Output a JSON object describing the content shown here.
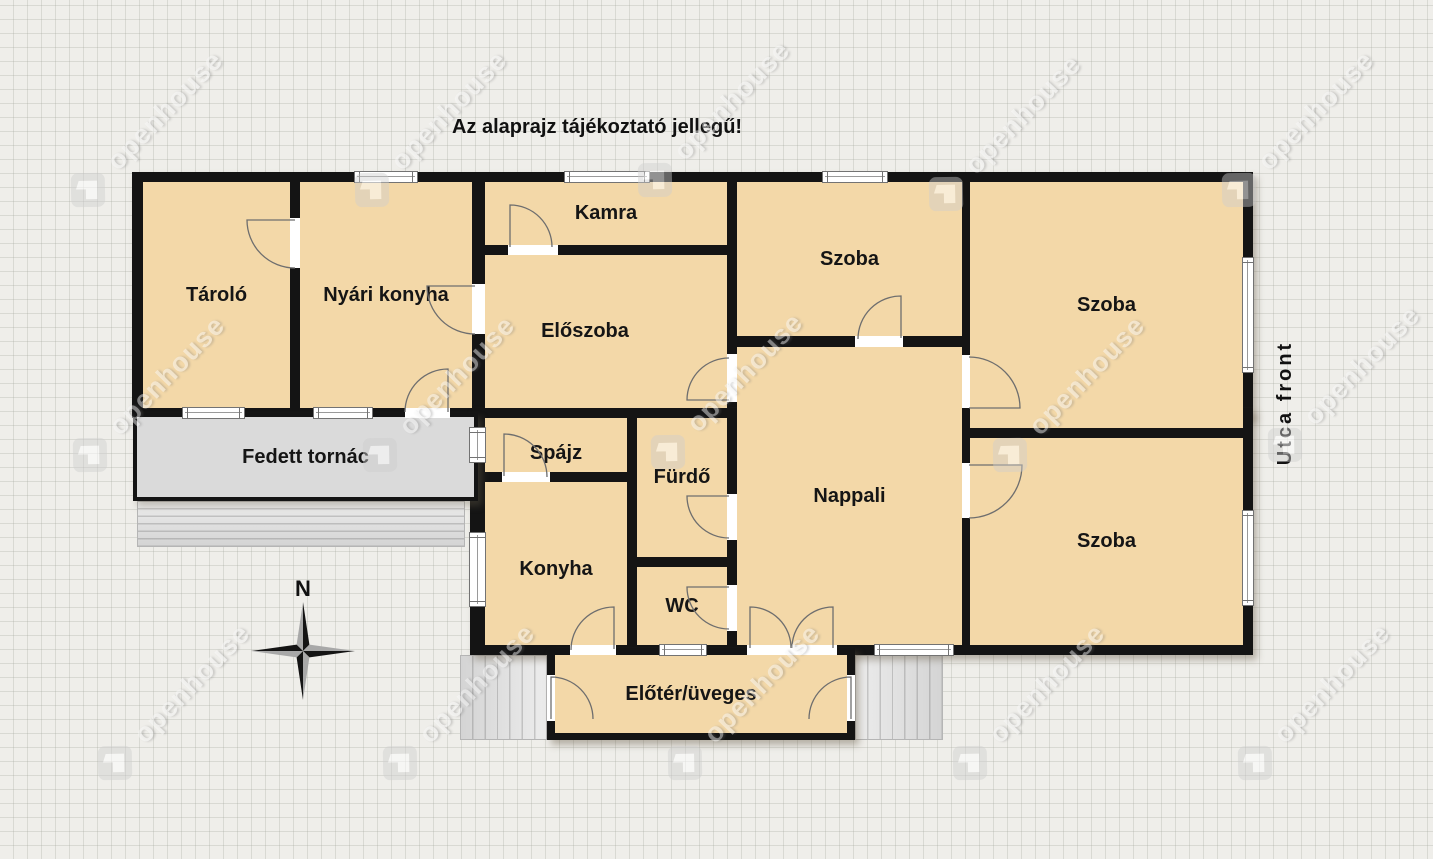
{
  "disclaimer": "Az alaprajz tájékoztató jellegű!",
  "street_front_label": "Utca front",
  "compass": {
    "north_label": "N"
  },
  "watermark": {
    "text": "openhouse"
  },
  "rooms": [
    {
      "name": "Tároló"
    },
    {
      "name": "Nyári konyha"
    },
    {
      "name": "Kamra"
    },
    {
      "name": "Előszoba"
    },
    {
      "name": "Szoba"
    },
    {
      "name": "Nappali"
    },
    {
      "name": "Szoba"
    },
    {
      "name": "Szoba"
    },
    {
      "name": "Spájz"
    },
    {
      "name": "Konyha"
    },
    {
      "name": "Fürdő"
    },
    {
      "name": "WC"
    },
    {
      "name": "Előtér/üveges"
    },
    {
      "name": "Fedett tornác"
    }
  ],
  "colors": {
    "room_fill": "#f3d8a8",
    "wall": "#141414",
    "porch_fill": "#dadada",
    "background": "#efeeea"
  }
}
